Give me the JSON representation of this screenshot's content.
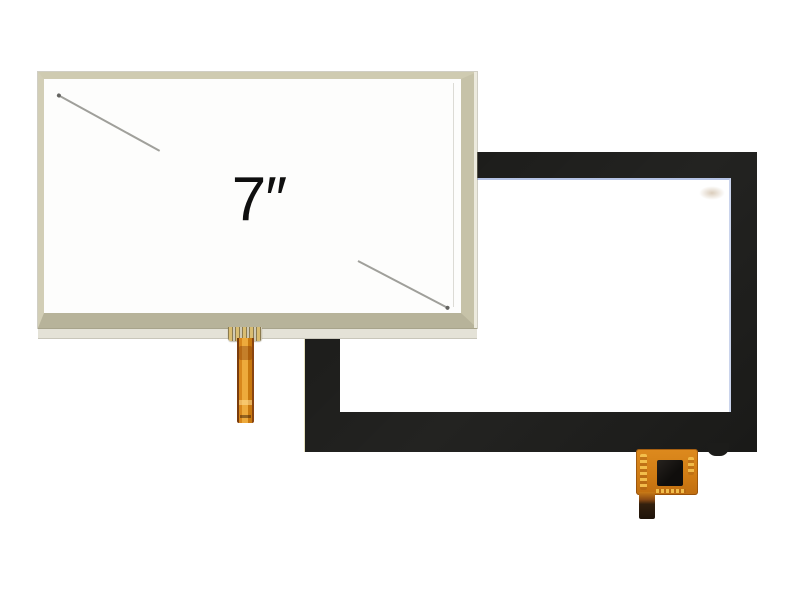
{
  "photo": {
    "size_label": "7″",
    "resistive_panel_alt": "7-inch resistive touch screen panel, beige frame, front",
    "capacitive_panel_alt": "capacitive touch screen panel, black frame, behind"
  },
  "colors": {
    "background": "#ffffff",
    "panel_white": "#fdfdfc",
    "resistive_frame": "#c6c2a8",
    "resistive_bottom_strip": "#e4e2d7",
    "capacitive_black": "#1c1c1a",
    "glass_edge_blue_t": "rgba(91,121,196,0.45)",
    "glass_edge_blue_r": "rgba(91,121,196,0.32)",
    "flex_orange": "#dd8a1e",
    "flex_tail_dark": "#33200e",
    "ic_black": "#100e0c",
    "pin_gold": "#d9bd72",
    "scratch_gray": "#8f8f8a",
    "label_black": "#0f0f0f"
  }
}
